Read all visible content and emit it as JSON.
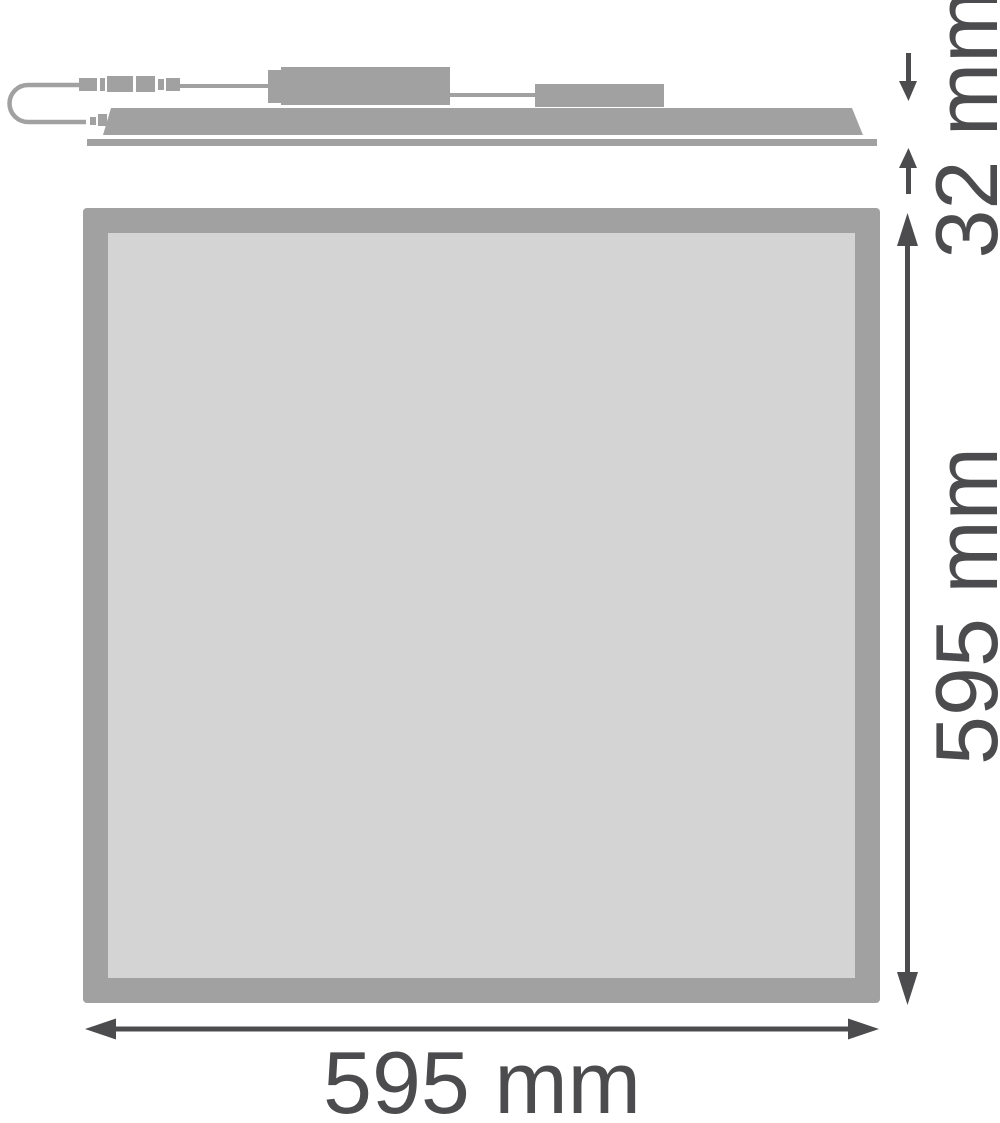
{
  "diagram": {
    "labels": {
      "thickness": "32 mm",
      "height": "595 mm",
      "width": "595 mm"
    },
    "colors": {
      "shape": "#a1a1a1",
      "panel_fill": "#d4d4d4",
      "dimension": "#4c4c4e",
      "background": "#ffffff"
    }
  }
}
